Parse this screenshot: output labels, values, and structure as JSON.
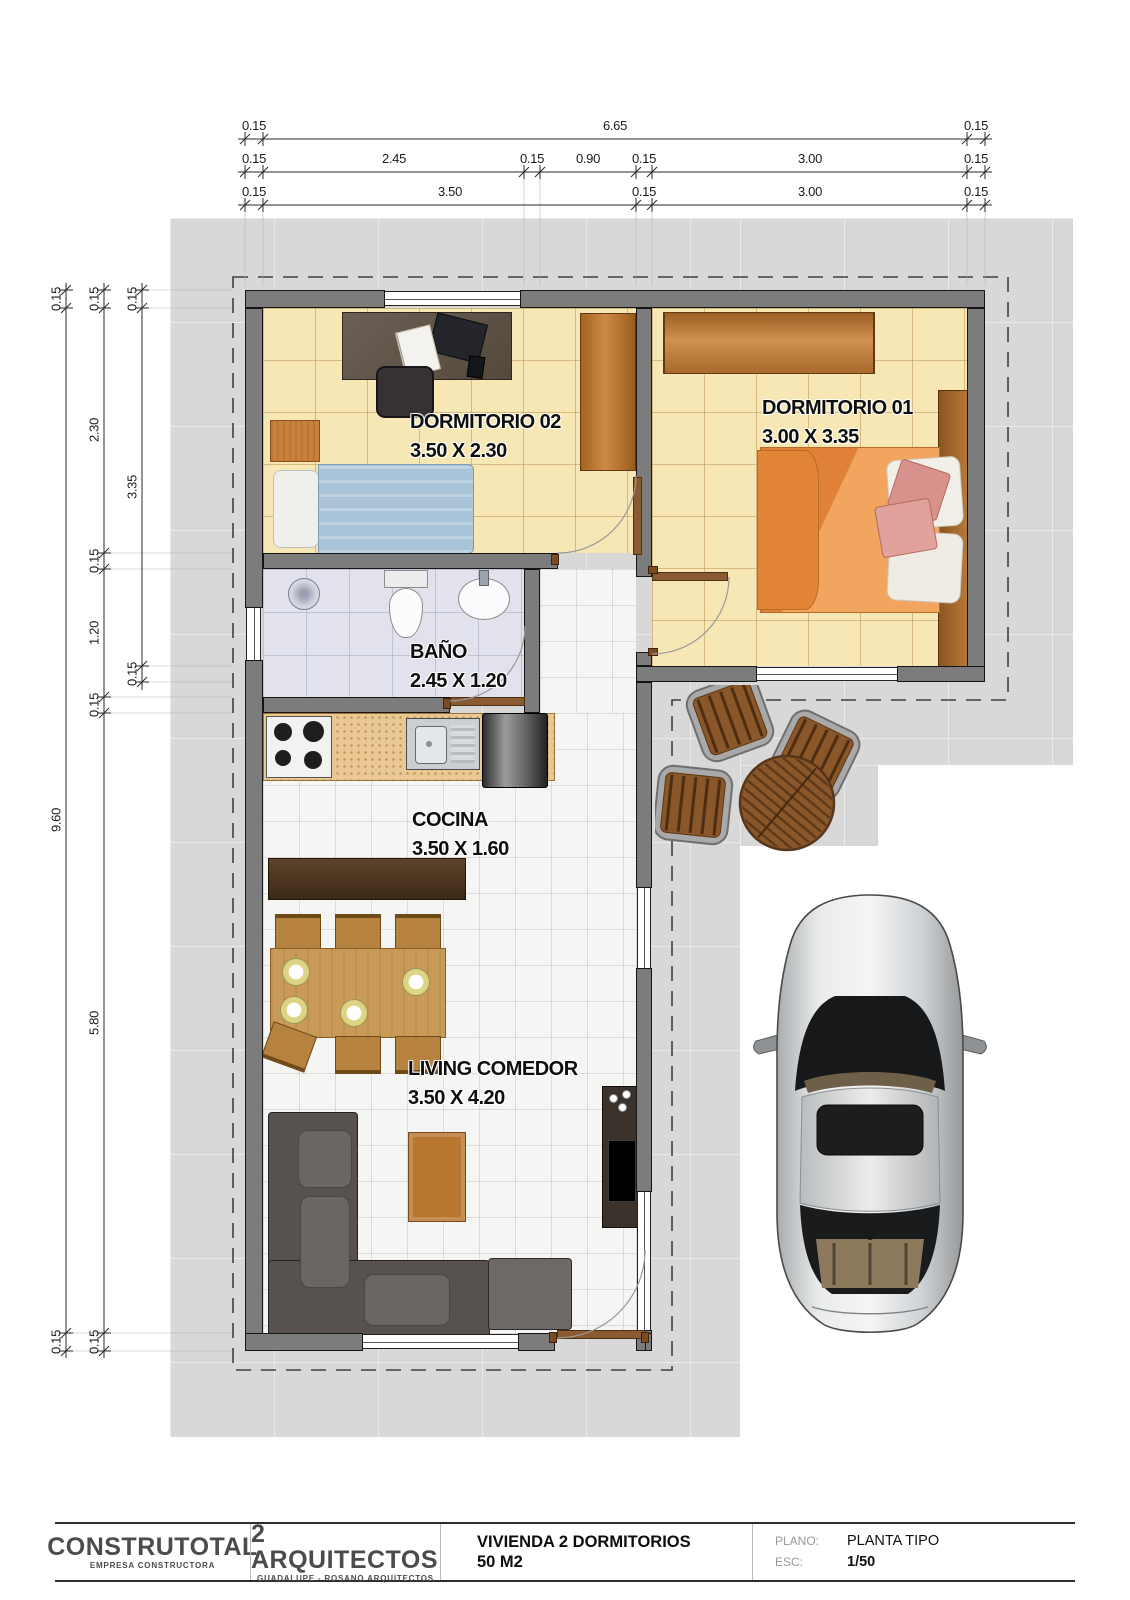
{
  "dimensions": {
    "top": {
      "row1": [
        "0.15",
        "6.65",
        "0.15"
      ],
      "row2": [
        "0.15",
        "2.45",
        "0.15",
        "0.90",
        "0.15",
        "3.00",
        "0.15"
      ],
      "row3": [
        "0.15",
        "3.50",
        "0.15",
        "3.00",
        "0.15"
      ]
    },
    "left": {
      "col1": [
        "0.15",
        "9.60",
        "0.15"
      ],
      "col2": [
        "0.15",
        "2.30",
        "0.15",
        "1.20",
        "0.15",
        "5.80",
        "0.15"
      ],
      "col3": [
        "0.15",
        "3.35",
        "0.15"
      ]
    }
  },
  "rooms": {
    "dormitorio02": {
      "name": "DORMITORIO 02",
      "size": "3.50 X 2.30"
    },
    "dormitorio01": {
      "name": "DORMITORIO 01",
      "size": "3.00 X 3.35"
    },
    "bano": {
      "name": "BAÑO",
      "size": "2.45 X 1.20"
    },
    "cocina": {
      "name": "COCINA",
      "size": "3.50 X 1.60"
    },
    "living": {
      "name": "LIVING COMEDOR",
      "size": "3.50 X 4.20"
    }
  },
  "title_block": {
    "company": "CONSTRUTOTAL",
    "company_sub": "EMPRESA CONSTRUCTORA",
    "studio": "2 ARQUITECTOS",
    "studio_sub": "GUADALUPE - ROSANO ARQUITECTOS",
    "project": "VIVIENDA 2 DORMITORIOS",
    "project_sub": "50 M2",
    "plano_label": "PLANO:",
    "plano_value": "PLANTA TIPO",
    "esc_label": "ESC:",
    "esc_value": "1/50"
  },
  "colors": {
    "wall": "#7c7c7c",
    "floor_bedroom": "#f6e7b4",
    "floor_bath": "#e2e2ec",
    "lot": "#d8d8d8",
    "bed1_cover": "#ef9d55",
    "bed2_cover": "#a9c3d8",
    "wood": "#b5722f",
    "sofa": "#575250"
  }
}
